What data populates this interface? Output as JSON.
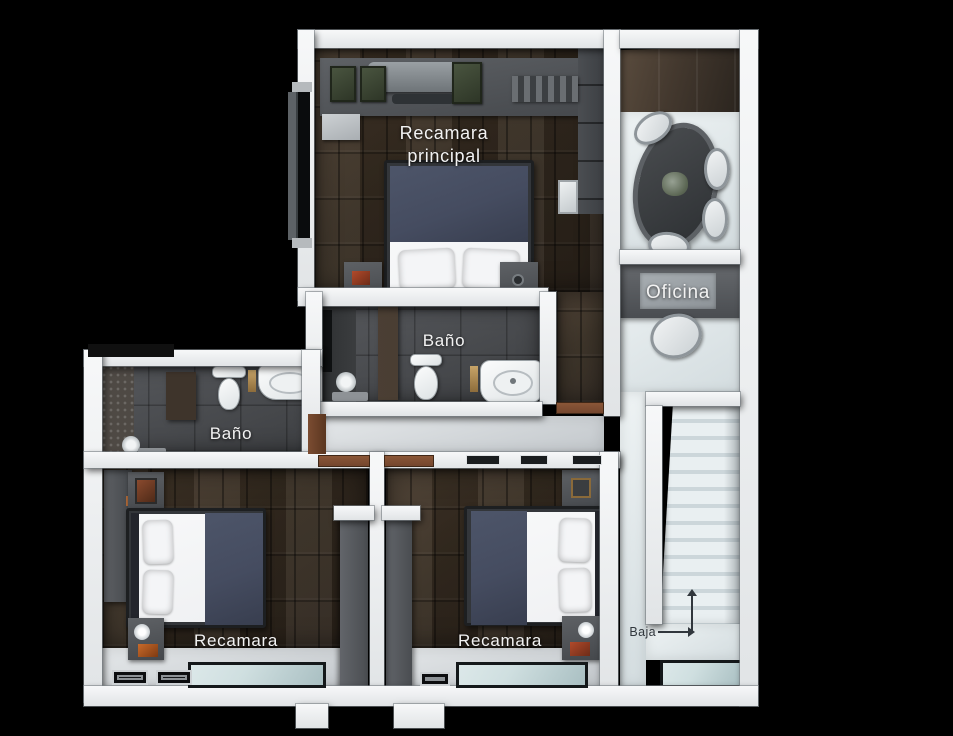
{
  "floorplan": {
    "view": "top-down 3D render, upper floor",
    "rooms": [
      {
        "id": "recamara-principal",
        "label": "Recamara principal",
        "features": [
          "double-bed",
          "nightstands",
          "wardrobe",
          "ac-unit",
          "window"
        ]
      },
      {
        "id": "bano-principal",
        "label": "Baño",
        "features": [
          "toilet",
          "vanity-sink",
          "shower"
        ]
      },
      {
        "id": "oficina",
        "label": "Oficina",
        "features": [
          "meeting-table",
          "chairs",
          "desk",
          "desk-chair"
        ]
      },
      {
        "id": "bano-secundario",
        "label": "Baño",
        "features": [
          "toilet",
          "sink",
          "shower",
          "mosaic-wall"
        ]
      },
      {
        "id": "recamara-izquierda",
        "label": "Recamara",
        "features": [
          "double-bed",
          "nightstands",
          "wardrobe",
          "balcony-window",
          "floor-registers"
        ]
      },
      {
        "id": "recamara-derecha",
        "label": "Recamara",
        "features": [
          "double-bed",
          "nightstands",
          "wardrobe",
          "balcony-window"
        ]
      }
    ],
    "stairs": {
      "label": "Baja"
    },
    "colors": {
      "background": "#000000",
      "wall": "#eef0f2",
      "wood_floor": "#342b21",
      "tile_floor": "#494b4e",
      "corridor_floor": "#d9dde0",
      "stair_tread": "#e9eff1",
      "stair_riser": "#ccd6da",
      "office_ceiling": "#43382e",
      "furniture_gray": "#53565a",
      "bedding_navy": "#454c60",
      "bedding_white": "#f0f1f3",
      "door_wood": "#74462e",
      "glass": "#cfdfe0",
      "label_light": "#f2f2f2",
      "label_dark": "#31373d",
      "accent_orange": "#b06a3a"
    }
  }
}
